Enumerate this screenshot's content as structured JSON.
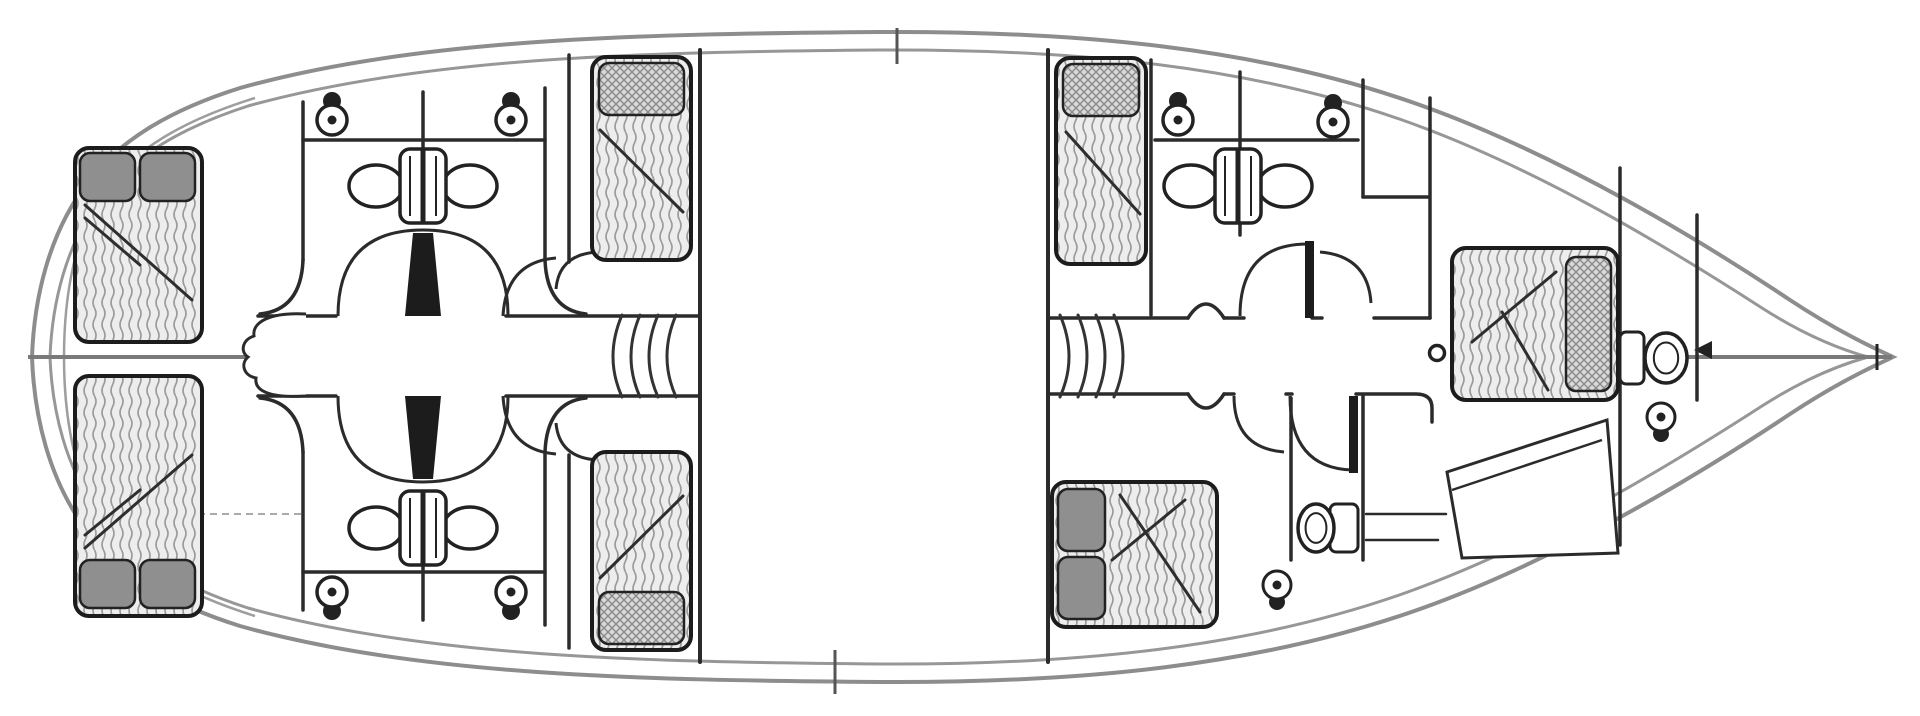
{
  "meta": {
    "name": "sailing-yacht-lower-deck-floor-plan",
    "type": "boat-deck-plan"
  },
  "colors": {
    "background": "#ffffff",
    "hull_line": "#8d8d8d",
    "hull_inner_line": "#979797",
    "wall": "#2b2b2b",
    "furniture_stroke": "#222222",
    "centerline": "#7a7a7a",
    "mattress_fill": "#ededed",
    "mattress_hatch": "#9b9b9b",
    "pillow_solid": "#8f8f8f",
    "pillow_lattice_bg": "#d9d9d9",
    "fold_line": "#2e2e2e",
    "stair_line": "#333333",
    "hidden_dash": "#aaaaaa"
  },
  "fixtures": {
    "beds": [
      {
        "name": "aft-port-double-bed",
        "x": 75,
        "y": 148,
        "w": 127,
        "h": 194,
        "pillow_style": "solid",
        "pillows": [
          {
            "x": 80,
            "y": 153,
            "w": 55,
            "h": 48
          },
          {
            "x": 140,
            "y": 153,
            "w": 55,
            "h": 48
          }
        ],
        "fold": [
          [
            85,
            205,
            192,
            300
          ],
          [
            85,
            218,
            140,
            265
          ]
        ]
      },
      {
        "name": "aft-starboard-double-bed",
        "x": 75,
        "y": 376,
        "w": 127,
        "h": 240,
        "pillow_style": "solid",
        "pillows": [
          {
            "x": 80,
            "y": 560,
            "w": 55,
            "h": 48
          },
          {
            "x": 140,
            "y": 560,
            "w": 55,
            "h": 48
          }
        ],
        "fold": [
          [
            85,
            548,
            192,
            455
          ],
          [
            85,
            535,
            140,
            490
          ]
        ]
      },
      {
        "name": "midship-port-single-bed",
        "x": 592,
        "y": 57,
        "w": 99,
        "h": 203,
        "pillow_style": "lattice",
        "pillows": [
          {
            "x": 599,
            "y": 63,
            "w": 85,
            "h": 52
          }
        ],
        "fold": [
          [
            600,
            130,
            683,
            212
          ]
        ]
      },
      {
        "name": "midship-starboard-single-bed",
        "x": 592,
        "y": 452,
        "w": 99,
        "h": 198,
        "pillow_style": "lattice",
        "pillows": [
          {
            "x": 599,
            "y": 592,
            "w": 85,
            "h": 52
          }
        ],
        "fold": [
          [
            600,
            578,
            683,
            496
          ]
        ]
      },
      {
        "name": "forward-port-single-bed",
        "x": 1056,
        "y": 58,
        "w": 90,
        "h": 206,
        "pillow_style": "lattice",
        "pillows": [
          {
            "x": 1063,
            "y": 64,
            "w": 76,
            "h": 52
          }
        ],
        "fold": [
          [
            1066,
            132,
            1140,
            214
          ]
        ]
      },
      {
        "name": "forward-starboard-double-bed",
        "x": 1052,
        "y": 482,
        "w": 165,
        "h": 145,
        "pillow_style": "solid",
        "pillows": [
          {
            "x": 1058,
            "y": 489,
            "w": 47,
            "h": 62
          },
          {
            "x": 1058,
            "y": 557,
            "w": 47,
            "h": 62
          }
        ],
        "fold": [
          [
            1112,
            560,
            1185,
            500
          ],
          [
            1120,
            495,
            1200,
            612
          ]
        ]
      },
      {
        "name": "bow-double-bed",
        "x": 1452,
        "y": 248,
        "w": 166,
        "h": 152,
        "pillow_style": "lattice",
        "pillows": [
          {
            "x": 1566,
            "y": 257,
            "w": 45,
            "h": 134
          }
        ],
        "fold": [
          [
            1556,
            272,
            1472,
            342
          ],
          [
            1502,
            312,
            1548,
            390
          ]
        ]
      }
    ],
    "toilets": [
      {
        "name": "wc-aft-port-1",
        "cx": 332,
        "cy": 120,
        "tank": "up"
      },
      {
        "name": "wc-aft-port-2",
        "cx": 511,
        "cy": 120,
        "tank": "up"
      },
      {
        "name": "wc-aft-starboard-1",
        "cx": 332,
        "cy": 592,
        "tank": "down"
      },
      {
        "name": "wc-aft-starboard-2",
        "cx": 511,
        "cy": 592,
        "tank": "down"
      },
      {
        "name": "wc-forward-port-1",
        "cx": 1178,
        "cy": 120,
        "tank": "up"
      },
      {
        "name": "wc-forward-port-2",
        "cx": 1333,
        "cy": 122,
        "tank": "up"
      }
    ],
    "side_toilets": [
      {
        "name": "wc-bow",
        "tank": {
          "x": 1620,
          "y": 332,
          "w": 24,
          "h": 52
        },
        "bowl": {
          "cx": 1666,
          "cy": 358,
          "rx": 21,
          "ry": 25
        }
      },
      {
        "name": "wc-forward-starboard",
        "tank": {
          "x": 1330,
          "y": 504,
          "w": 28,
          "h": 48
        },
        "bowl": {
          "cx": 1316,
          "cy": 528,
          "rx": 18,
          "ry": 24
        }
      }
    ],
    "double_sinks": [
      {
        "name": "double-washbasin-aft-port",
        "cx": 423,
        "cy": 186
      },
      {
        "name": "double-washbasin-aft-starboard",
        "cx": 423,
        "cy": 528
      },
      {
        "name": "double-washbasin-forward",
        "cx": 1238,
        "cy": 186
      }
    ],
    "round_sinks": [
      {
        "name": "washbasin-forward-starboard",
        "cx": 1277,
        "cy": 585
      },
      {
        "name": "washbasin-bow",
        "cx": 1661,
        "cy": 417
      }
    ],
    "stairs": [
      {
        "name": "companionway-steps-port",
        "x": 622,
        "dir": -1,
        "count": 4
      },
      {
        "name": "companionway-steps-starboard",
        "x": 1060,
        "dir": 1,
        "count": 4
      }
    ]
  }
}
